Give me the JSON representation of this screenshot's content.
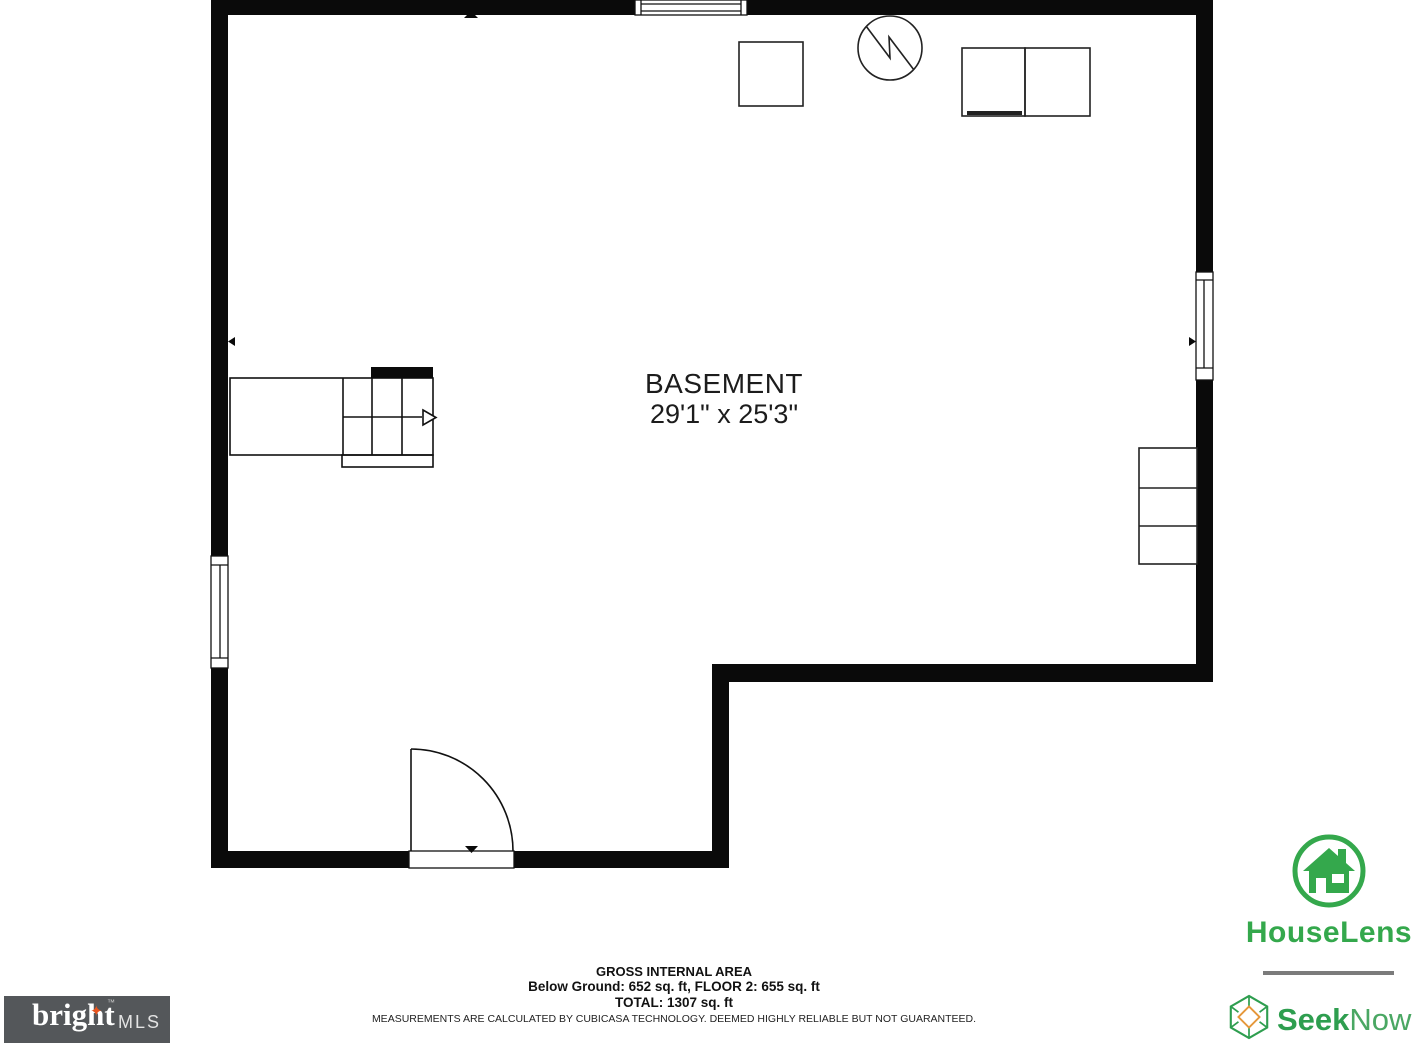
{
  "floorplan": {
    "room": {
      "name": "BASEMENT",
      "dimensions": "29'1\" x 25'3\""
    },
    "wall_color": "#0a0a0a"
  },
  "footer": {
    "title": "GROSS INTERNAL AREA",
    "area_line": "Below Ground: 652 sq. ft, FLOOR 2: 655 sq. ft",
    "total_line": "TOTAL: 1307 sq. ft",
    "disclaimer": "MEASUREMENTS ARE CALCULATED BY CUBICASA TECHNOLOGY. DEEMED HIGHLY RELIABLE BUT NOT GUARANTEED."
  },
  "logos": {
    "bright_mls": {
      "word": "bright",
      "suffix": "MLS",
      "trademark": "™",
      "background": "#54575a",
      "star_color": "#e8541d"
    },
    "houselens": {
      "label": "HouseLens",
      "green": "#34a84c"
    },
    "seeknow": {
      "word_bold": "Seek",
      "word_regular": "Now",
      "green": "#2e9e4f",
      "light_green": "#4aa763",
      "orange": "#e5973a"
    }
  },
  "icons": {
    "star": "✦"
  }
}
